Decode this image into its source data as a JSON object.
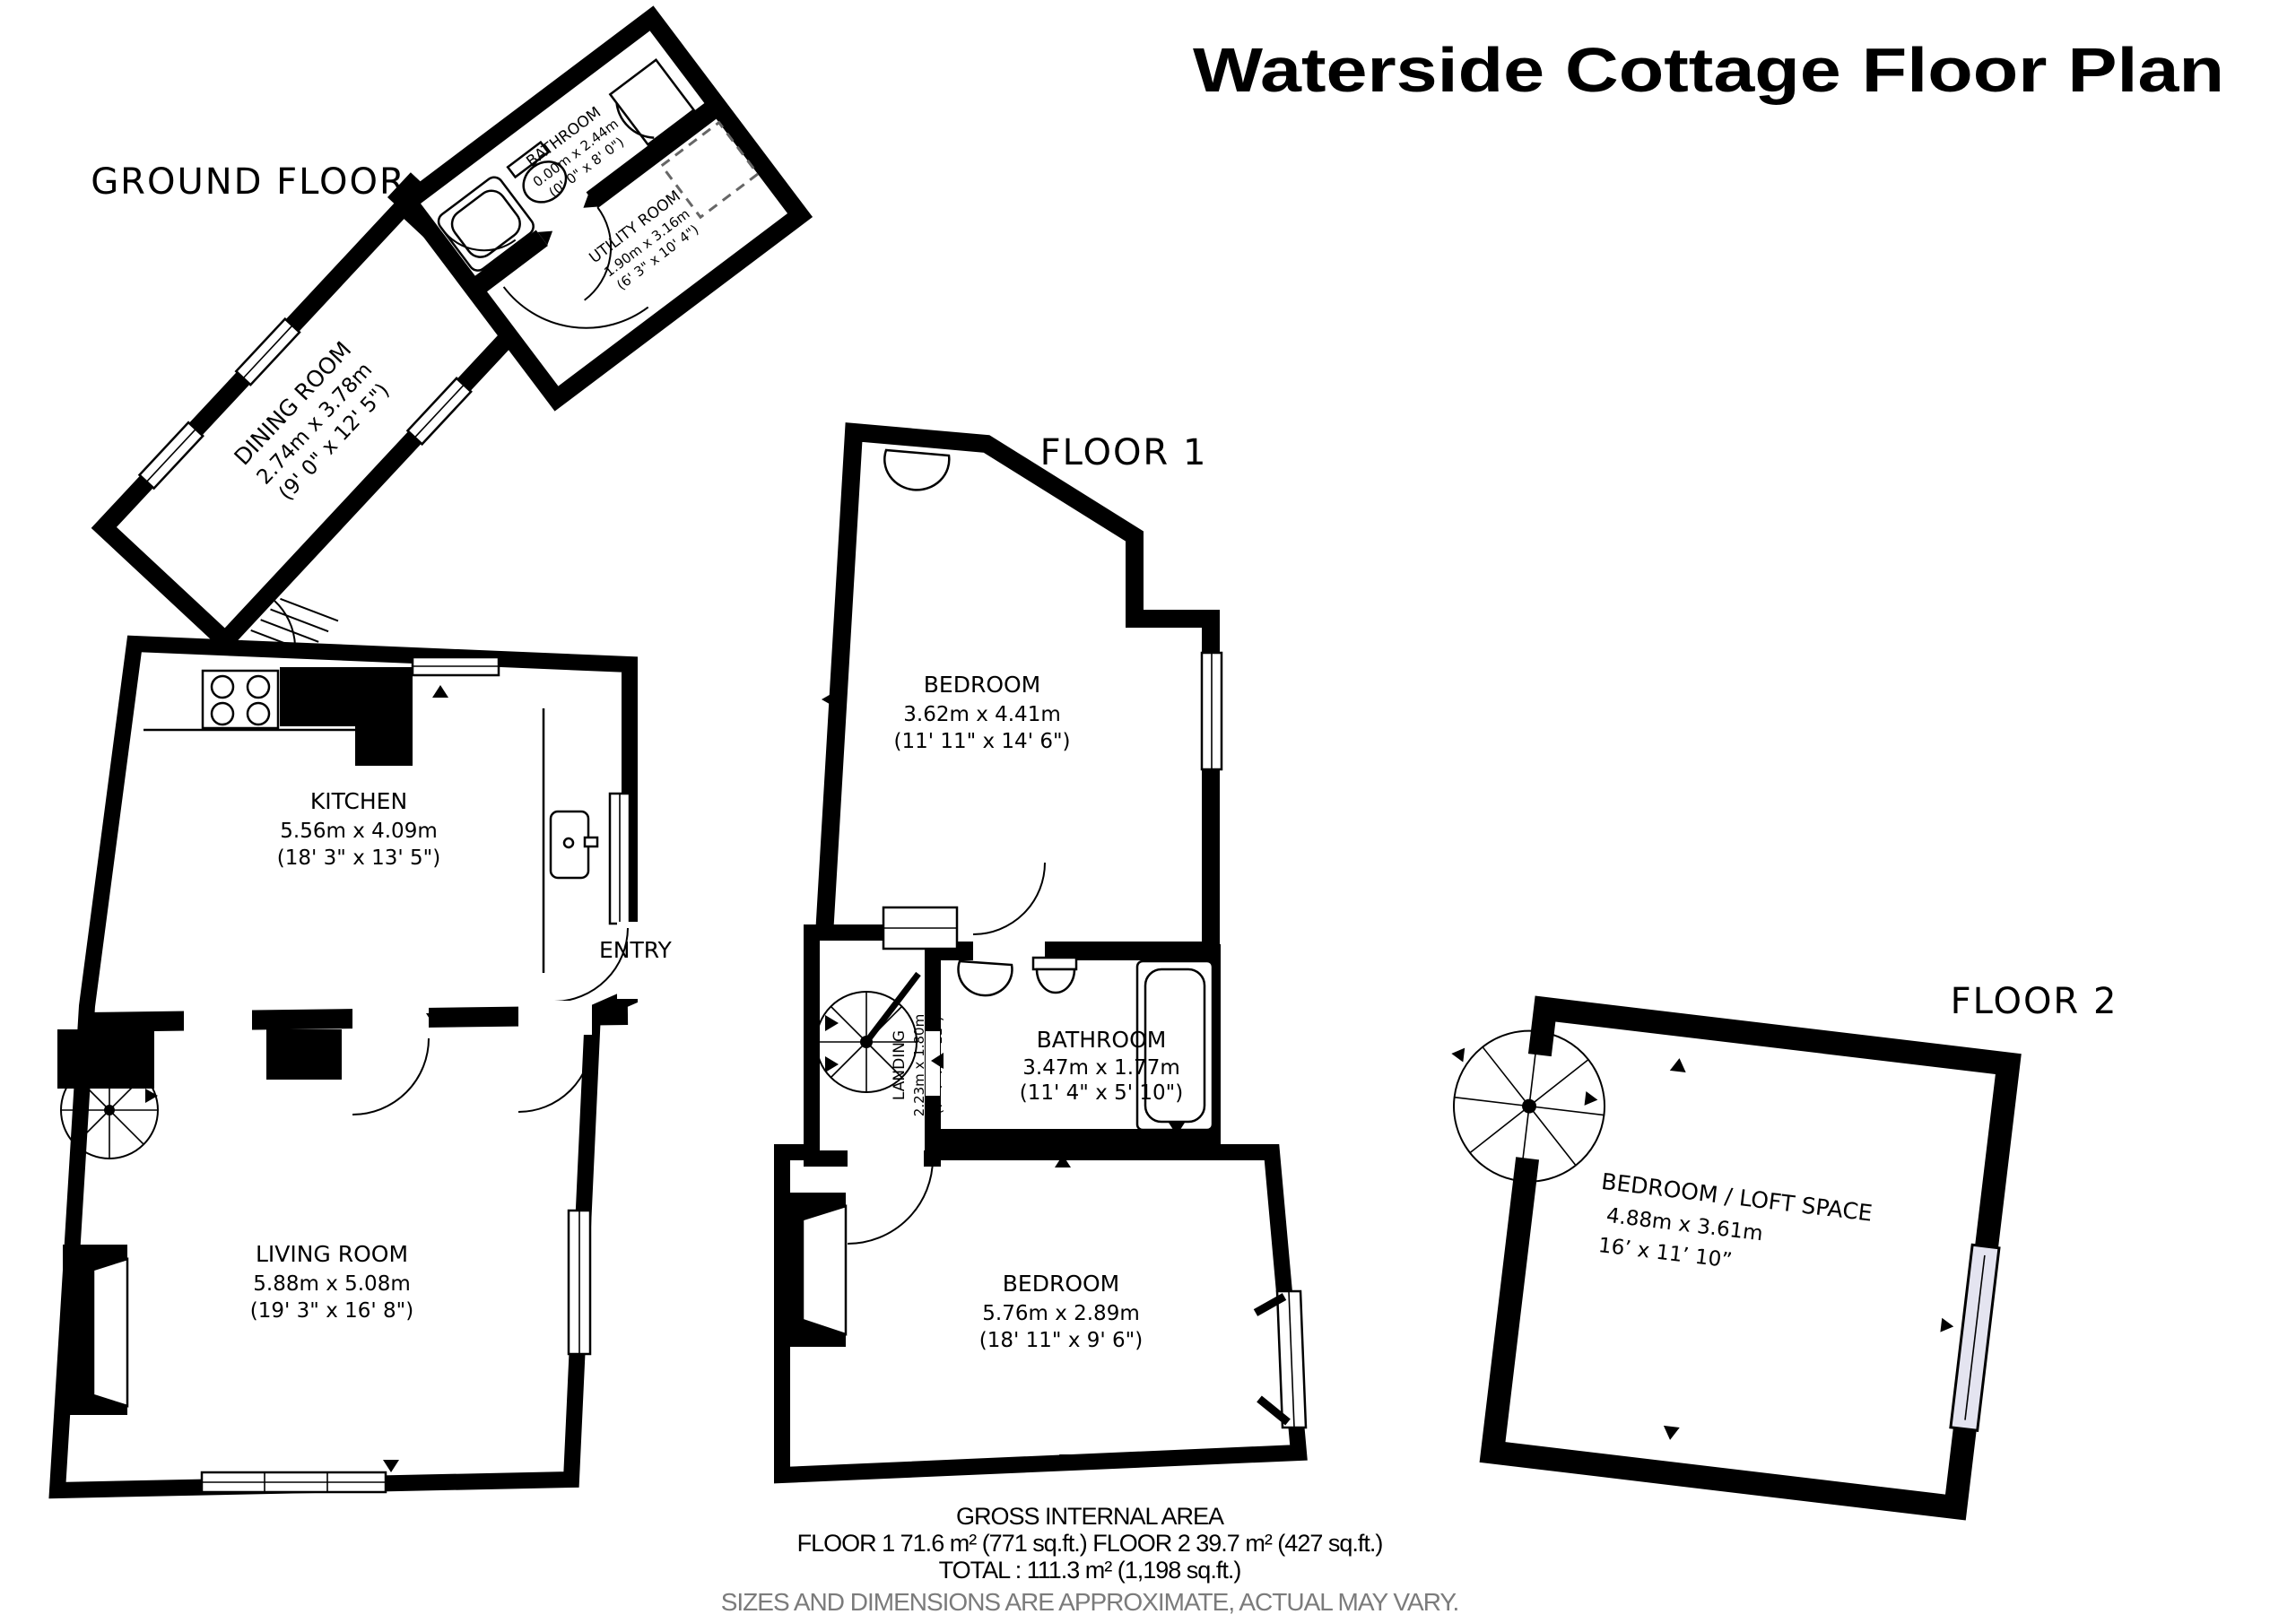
{
  "title": "Waterside Cottage Floor Plan",
  "ground": {
    "label": "GROUND FLOOR",
    "dining": {
      "name": "DINING ROOM",
      "metric": "2.74m x 3.78m",
      "imperial": "(9' 0\" x 12' 5\")"
    },
    "bathroom": {
      "name": "BATHROOM",
      "metric": "0.00m x 2.44m",
      "imperial": "(0' 0\" x 8' 0\")"
    },
    "utility": {
      "name": "UTILITY ROOM",
      "metric": "1.90m x 3.16m",
      "imperial": "(6' 3\" x 10' 4\")"
    },
    "kitchen": {
      "name": "KITCHEN",
      "metric": "5.56m x 4.09m",
      "imperial": "(18' 3\" x 13' 5\")"
    },
    "living": {
      "name": "LIVING ROOM",
      "metric": "5.88m x 5.08m",
      "imperial": "(19' 3\" x 16' 8\")"
    },
    "entry_label": "ENTRY"
  },
  "floor1": {
    "label": "FLOOR 1",
    "bedroom_top": {
      "name": "BEDROOM",
      "metric": "3.62m x 4.41m",
      "imperial": "(11' 11\" x 14' 6\")"
    },
    "landing": {
      "name": "LANDING",
      "metric": "2.23m x 1.80m",
      "imperial": "(7' 4\" x 5' 11\")"
    },
    "bathroom": {
      "name": "BATHROOM",
      "metric": "3.47m x 1.77m",
      "imperial": "(11' 4\" x 5' 10\")"
    },
    "bedroom_bottom": {
      "name": "BEDROOM",
      "metric": "5.76m x 2.89m",
      "imperial": "(18' 11\" x 9' 6\")"
    }
  },
  "floor2": {
    "label": "FLOOR 2",
    "loft": {
      "name": "BEDROOM / LOFT SPACE",
      "metric": "4.88m x 3.61m",
      "imperial": "16’ x 11’ 10”"
    }
  },
  "footer": {
    "heading": "GROSS INTERNAL AREA",
    "floors_line": "FLOOR 1 71.6 m² (771 sq.ft.)   FLOOR 2 39.7 m² (427 sq.ft.)",
    "total_line": "TOTAL :  111.3 m² (1,198 sq.ft.)",
    "disclaimer": "SIZES AND DIMENSIONS ARE APPROXIMATE, ACTUAL MAY VARY."
  }
}
